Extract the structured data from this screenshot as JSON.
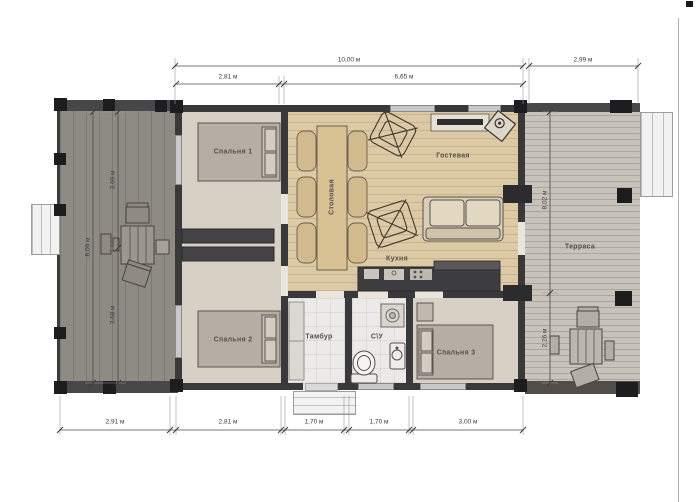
{
  "floor_plan": {
    "rooms": {
      "bedroom1": "Спальня 1",
      "bedroom2": "Спальня 2",
      "bedroom3": "Спальня 3",
      "dining": "Столовая",
      "living": "Гостевая",
      "kitchen": "Кухня",
      "vestibule": "Тамбур",
      "bathroom": "С\\У",
      "terrace": "Терраса"
    },
    "dimensions": {
      "top_total": "10,00 м",
      "top_left": "2,81 м",
      "top_right": "6,65 м",
      "top_terrace": "2,99 м",
      "bottom_deck": "2,91 м",
      "bottom_bedroom": "2,81 м",
      "bottom_entry": "1,70 м",
      "bottom_wc": "1,70 м",
      "bottom_bedroom3": "3,00 м",
      "left_total": "8,00 м",
      "left_upper": "3,69 м",
      "left_lower": "3,68 м",
      "right_upper": "8,02 м",
      "right_lower": "2,26 м"
    },
    "colors": {
      "wall": "#39393b",
      "interior_wood": "#dccaa6",
      "bedroom_floor": "#d7d0c4",
      "left_deck": "#8e8b85",
      "terrace": "#c7c2ba",
      "tile": "#ebeae8",
      "dimension_line": "#4a4a4a"
    }
  }
}
